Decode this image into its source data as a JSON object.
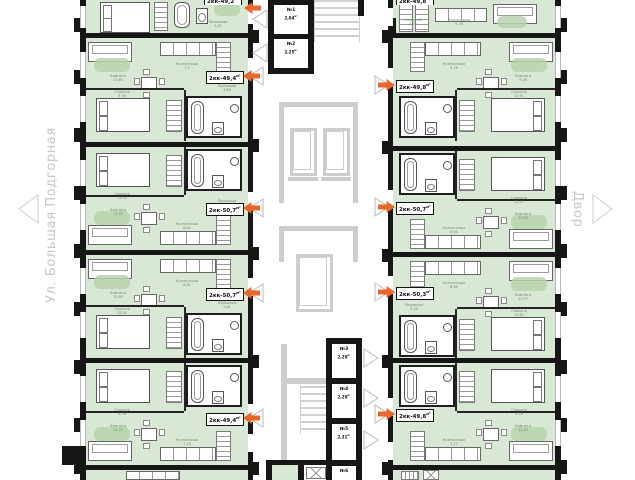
{
  "unit": "м²",
  "streets": {
    "left": "Ул. Большая Подгорная",
    "right": "Двор"
  },
  "apartments": [
    {
      "id": "L1",
      "type": "2кк",
      "area": "49,2",
      "rooms": [
        {
          "n": "Прихожая",
          "a": "5,61",
          "x": 132,
          "y": 20
        }
      ]
    },
    {
      "id": "L2",
      "type": "2кк",
      "area": "49,4",
      "rooms": [
        {
          "n": "Комната",
          "a": "13,65",
          "x": 32,
          "y": 36
        },
        {
          "n": "Кухня-ниша",
          "a": "7,0",
          "x": 101,
          "y": 24
        },
        {
          "n": "Прихожая",
          "a": "3,86",
          "x": 141,
          "y": 46
        },
        {
          "n": "Спальня",
          "a": "9,76",
          "x": 36,
          "y": 52
        }
      ]
    },
    {
      "id": "L3",
      "type": "2кк",
      "area": "50,7",
      "rooms": [
        {
          "n": "Спальня",
          "a": "12,01",
          "x": 36,
          "y": 45
        },
        {
          "n": "Прихожая",
          "a": "5,61",
          "x": 141,
          "y": 52
        },
        {
          "n": "Комната",
          "a": "13,45",
          "x": 32,
          "y": 61
        },
        {
          "n": "Кухня-ниша",
          "a": "8,61",
          "x": 101,
          "y": 75
        }
      ]
    },
    {
      "id": "L4",
      "type": "2кк",
      "area": "50,7",
      "rooms": [
        {
          "n": "Комната",
          "a": "13,65",
          "x": 32,
          "y": 36
        },
        {
          "n": "Кухня-ниша",
          "a": "8,61",
          "x": 101,
          "y": 24
        },
        {
          "n": "Прихожая",
          "a": "5,61",
          "x": 141,
          "y": 46
        },
        {
          "n": "Спальня",
          "a": "12,91",
          "x": 36,
          "y": 52
        }
      ]
    },
    {
      "id": "L5",
      "type": "2кк",
      "area": "49,4",
      "rooms": [
        {
          "n": "Спальня",
          "a": "9,76",
          "x": 36,
          "y": 45
        },
        {
          "n": "Прихожая",
          "a": "1,87",
          "x": 141,
          "y": 52
        },
        {
          "n": "Комната",
          "a": "11,25",
          "x": 32,
          "y": 61
        },
        {
          "n": "Кухня-ниша",
          "a": "7,18",
          "x": 101,
          "y": 75
        }
      ]
    },
    {
      "id": "R1",
      "type": "2кк",
      "area": "49,8",
      "rooms": [
        {
          "n": "Гардероб",
          "a": "2,72",
          "x": 20,
          "y": 18
        },
        {
          "n": "Кухня-ниша",
          "a": "5,28",
          "x": 66,
          "y": 18
        }
      ]
    },
    {
      "id": "R2",
      "type": "2кк",
      "area": "49,8",
      "rooms": [
        {
          "n": "Комната",
          "a": "9,28",
          "x": 130,
          "y": 36
        },
        {
          "n": "Кухня-ниша",
          "a": "5,28",
          "x": 61,
          "y": 24
        },
        {
          "n": "Прихожая",
          "a": "4,67",
          "x": 21,
          "y": 46
        },
        {
          "n": "Спальня",
          "a": "12,91",
          "x": 126,
          "y": 52
        }
      ]
    },
    {
      "id": "R3",
      "type": "2кк",
      "area": "50,7",
      "rooms": [
        {
          "n": "Спальня",
          "a": "12,97",
          "x": 126,
          "y": 45
        },
        {
          "n": "Прихожая",
          "a": "5,05",
          "x": 21,
          "y": 52
        },
        {
          "n": "Комната",
          "a": "13,45",
          "x": 130,
          "y": 61
        },
        {
          "n": "Кухня-ниша",
          "a": "8,61",
          "x": 61,
          "y": 75
        }
      ]
    },
    {
      "id": "R4",
      "type": "2кк",
      "area": "50,3",
      "rooms": [
        {
          "n": "Комната",
          "a": "12,97",
          "x": 130,
          "y": 36
        },
        {
          "n": "Кухня-ниша",
          "a": "8,80",
          "x": 61,
          "y": 24
        },
        {
          "n": "Прихожая",
          "a": "5,26",
          "x": 21,
          "y": 46
        },
        {
          "n": "Спальня",
          "a": "12,81",
          "x": 126,
          "y": 52
        }
      ]
    },
    {
      "id": "R5",
      "type": "2кк",
      "area": "49,8",
      "rooms": [
        {
          "n": "Спальня",
          "a": "9,76",
          "x": 126,
          "y": 45
        },
        {
          "n": "Прихожая",
          "a": "4,67",
          "x": 21,
          "y": 52
        },
        {
          "n": "Комната",
          "a": "11,25",
          "x": 130,
          "y": 61
        },
        {
          "n": "Кухня-ниша",
          "a": "7,17",
          "x": 61,
          "y": 75
        }
      ]
    }
  ],
  "balconies_top": [
    {
      "num": "№1",
      "area": "2,04"
    },
    {
      "num": "№2",
      "area": "2,25"
    }
  ],
  "balconies_bottom": [
    {
      "num": "№3",
      "area": "2,29"
    },
    {
      "num": "№4",
      "area": "2,29"
    },
    {
      "num": "№5",
      "area": "2,31"
    },
    {
      "num": "№6",
      "area": ""
    }
  ],
  "colors": {
    "room_fill": "#d9e8d4",
    "rug": "#b7d3ad",
    "wall": "#161616",
    "core_gray": "#cdcdcd",
    "arrow_orange": "#e8682c",
    "street_text": "#c7c7c7"
  }
}
